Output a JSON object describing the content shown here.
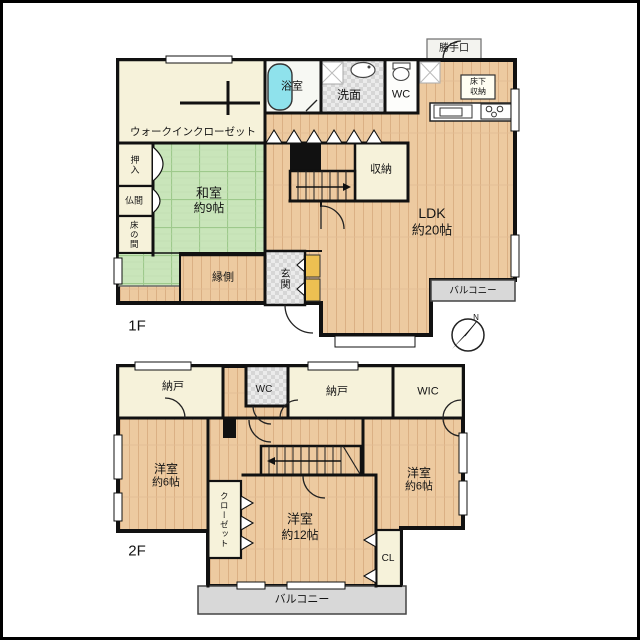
{
  "floor1": {
    "floor_label": "1F",
    "walk_in_closet": "ウォークインクローゼット",
    "bathroom": "浴室",
    "washroom": "洗面",
    "toilet": "WC",
    "back_door": "勝手口",
    "underfloor_storage_line1": "床下",
    "underfloor_storage_line2": "収納",
    "storage": "収納",
    "japanese_room_name": "和室",
    "japanese_room_size": "約9帖",
    "oshiire": "押入",
    "butsuma": "仏間",
    "tokonoma": "床の間",
    "engawa": "縁側",
    "entrance": "玄関",
    "ldk_name": "LDK",
    "ldk_size": "約20帖",
    "balcony": "バルコニー",
    "compass_north": "N"
  },
  "floor2": {
    "floor_label": "2F",
    "storage_room_left": "納戸",
    "toilet": "WC",
    "storage_room_center": "納戸",
    "walk_in_closet": "WIC",
    "bedroom_left_name": "洋室",
    "bedroom_left_size": "約6帖",
    "closet": "クローゼット",
    "bedroom_center_name": "洋室",
    "bedroom_center_size": "約12帖",
    "closet_cl": "CL",
    "bedroom_right_name": "洋室",
    "bedroom_right_size": "約6帖",
    "balcony": "バルコニー"
  },
  "colors": {
    "wood_floor": "#edcaa0",
    "tatami_green": "#c9e5ba",
    "cream_room": "#f6f2da",
    "tile_gray": "#d6d6d6",
    "balcony_gray": "#d8d8d8",
    "bathtub_cyan": "#8fe2ec",
    "entrance_step_yellow": "#edc052",
    "wall_black": "#111111"
  }
}
